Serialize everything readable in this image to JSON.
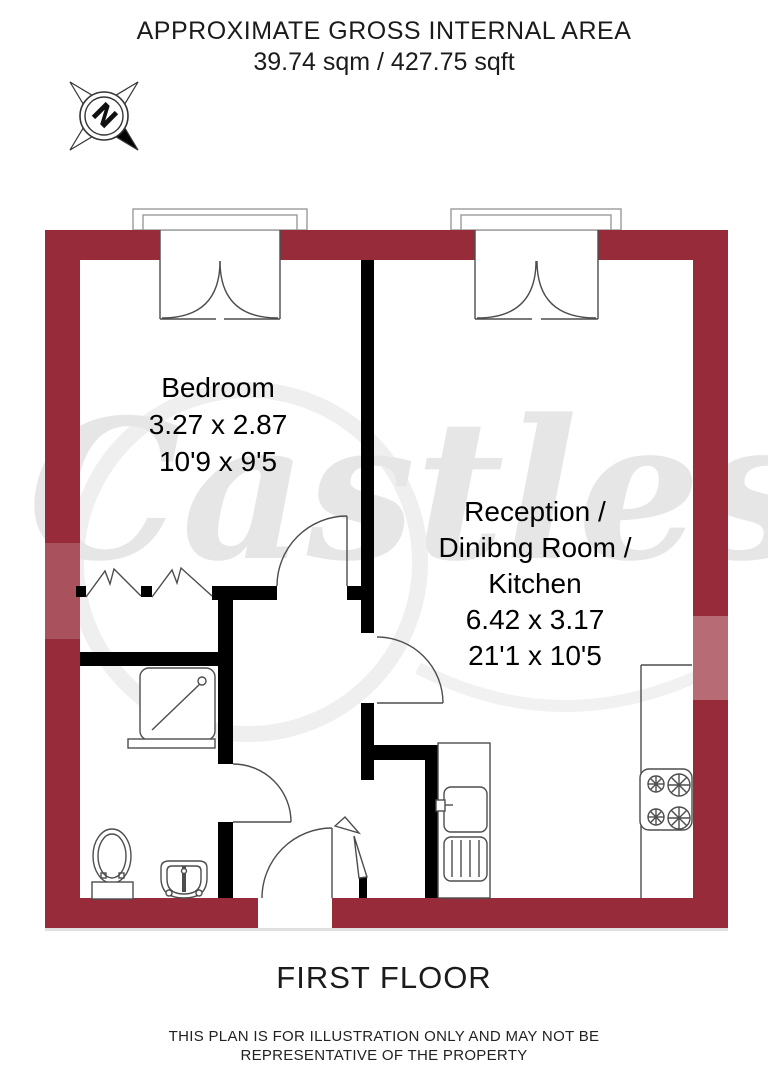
{
  "header": {
    "title": "APPROXIMATE GROSS INTERNAL AREA",
    "area": "39.74 sqm / 427.75 sqft"
  },
  "compass": {
    "north_label": "N"
  },
  "watermark": {
    "text": "Castles"
  },
  "rooms": {
    "bedroom": {
      "name": "Bedroom",
      "metric": "3.27 x 2.87",
      "imperial": "10'9 x 9'5"
    },
    "reception": {
      "line1": "Reception /",
      "line2": "Dinibng Room /",
      "line3": "Kitchen",
      "metric": "6.42 x 3.17",
      "imperial": "21'1 x 10'5"
    }
  },
  "footer": {
    "floor_label": "FIRST FLOOR",
    "disclaimer1": "THIS PLAN IS FOR ILLUSTRATION ONLY AND MAY NOT BE",
    "disclaimer2": "REPRESENTATIVE OF THE PROPERTY"
  },
  "colors": {
    "outer_wall": "#972B3A",
    "interior_wall": "#000000",
    "fixture_line": "#4d4d4d",
    "watermark": "#E6E6E6"
  }
}
